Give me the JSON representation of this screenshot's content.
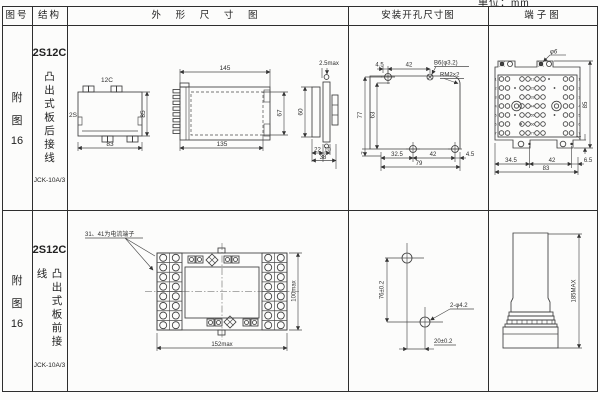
{
  "page": {
    "unit_label": "单位：mm"
  },
  "header": {
    "fig": "图号",
    "structure": "结构",
    "outline": "外 形 尺 寸 图",
    "mounting": "安装开孔尺寸图",
    "terminal": "端子图"
  },
  "rows": [
    {
      "fig": {
        "c1": "附",
        "c2": "图",
        "num": "16"
      },
      "model": "2S12C",
      "mounting_type": "凸出式板后接线",
      "product": "JCK-10A/3",
      "outline": {
        "rear_top_label": "12C",
        "rear_left_label": "2S",
        "rear_h": "85",
        "rear_w": "83",
        "side_top": "145",
        "side_inner_h": "67",
        "end_h": "60",
        "side_bottom": "135",
        "end_gap": "2.5max",
        "end_b1": "22",
        "end_b2": "10",
        "end_total": "38"
      },
      "mounting": {
        "top_d1": "4.5",
        "top_d2": "42",
        "hole_label": "B6(φ3.2)",
        "thread_label": "RM2×2",
        "left_outer": "77",
        "left_inner": "63",
        "bottom_offset": "7",
        "bottom_d1": "32.5",
        "bottom_d2": "42",
        "bottom_d3": "4.5",
        "bottom_total": "79"
      },
      "terminal": {
        "callout": "φ6",
        "height": "85",
        "tab_height": "4",
        "bottom_d1": "34.5",
        "bottom_d2": "42",
        "bottom_d3": "6.5",
        "bottom_total": "83",
        "row_numbers": [
          "1",
          "2",
          "3",
          "4",
          "5",
          "6",
          "7"
        ],
        "mid_numbers": [
          "11",
          "22",
          "33",
          "44",
          "55",
          "66",
          "77"
        ]
      }
    },
    {
      "fig": {
        "c1": "附",
        "c2": "图",
        "num": "16"
      },
      "model": "2S12C",
      "mounting_type": "凸出式板前接线",
      "product": "JCK-10A/3",
      "outline": {
        "note": "31、41为电流端子",
        "width": "152max",
        "height": "100max"
      },
      "mounting": {
        "vertical": "76±0.2",
        "horizontal": "20±0.2",
        "hole_label": "2-φ4.2"
      },
      "terminal": {
        "height": "185MAX"
      }
    }
  ]
}
